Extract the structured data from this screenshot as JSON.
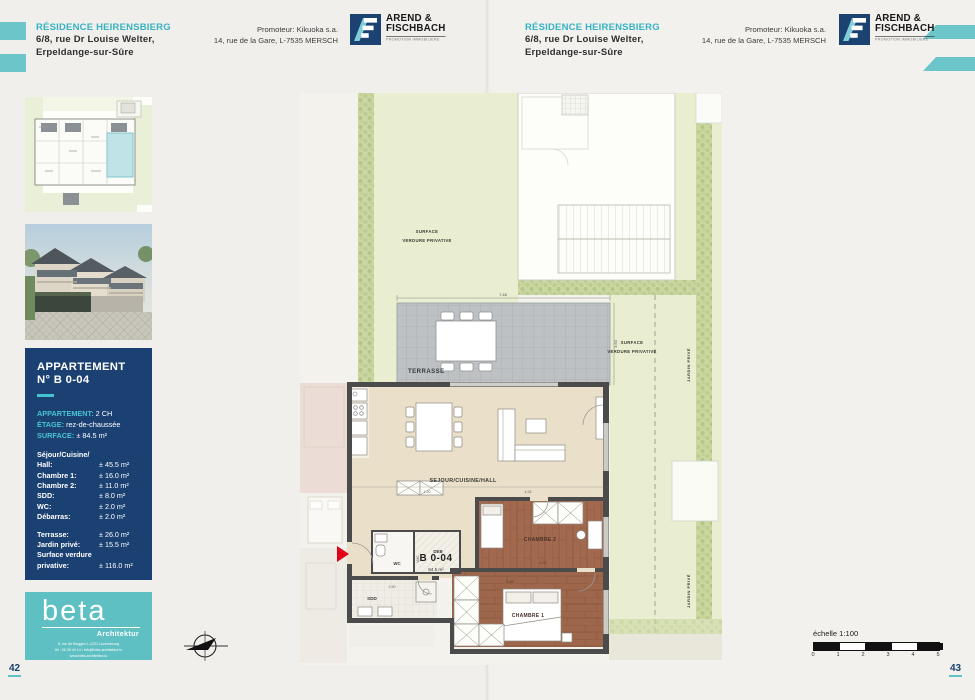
{
  "colors": {
    "accent_teal": "#6cc5c8",
    "title_teal": "#35b2c3",
    "brand_navy": "#1b4173",
    "beta_teal": "#5fc0c3",
    "plan_green": "#e8eecf",
    "wood_brown": "#a2694e",
    "terrace_grey": "#bdc1c3",
    "floor_beige": "#eadfc8",
    "entrance_red": "#e2001a"
  },
  "header": {
    "residence_title": "RÉSIDENCE HEIRENSBIERG",
    "address_line1": "6/8, rue Dr Louise Welter,",
    "address_line2": "Erpeldange-sur-Sûre",
    "promoter_line1": "Promoteur: Kikuoka s.a.",
    "promoter_line2": "14, rue de la Gare, L-7535 MERSCH",
    "logo": {
      "monogram": "AF",
      "name_line1": "AREND &",
      "name_line2": "FISCHBACH",
      "tagline": "PROMOTION IMMOBILIERE"
    }
  },
  "info_box": {
    "title_line1": "APPARTEMENT",
    "title_line2": "N° B 0-04",
    "spec_apartment_label": "APPARTEMENT:",
    "spec_apartment_value": "2 CH",
    "spec_floor_label": "ÉTAGE:",
    "spec_floor_value": "rez-de-chaussée",
    "spec_surface_label": "SURFACE:",
    "spec_surface_value": "± 84.5 m²",
    "rooms": [
      {
        "label": "Séjour/Cuisine/",
        "value": ""
      },
      {
        "label": "Hall:",
        "value": "± 45.5 m²"
      },
      {
        "label": "Chambre 1:",
        "value": "± 16.0 m²"
      },
      {
        "label": "Chambre 2:",
        "value": "± 11.0 m²"
      },
      {
        "label": "SDD:",
        "value": "± 8.0 m²"
      },
      {
        "label": "WC:",
        "value": "± 2.0 m²"
      },
      {
        "label": "Débarras:",
        "value": "± 2.0 m²"
      }
    ],
    "outdoor": [
      {
        "label": "Terrasse:",
        "value": "± 26.0 m²"
      },
      {
        "label": "Jardin privé:",
        "value": "± 15.5 m²"
      },
      {
        "label": "Surface verdure",
        "value": ""
      },
      {
        "label": "privative:",
        "value": "± 116.0 m²"
      }
    ]
  },
  "beta": {
    "name": "beta",
    "subtitle": "Architektur",
    "address_line1": "5, rue de Beggen L-1221 Luxembourg",
    "address_line2": "tél : 26 09 44 14 / info@beta-architektur.lu",
    "address_line3": "www.beta-architektur.lu"
  },
  "plan": {
    "unit_id": "B 0-04",
    "unit_area": "84.5 m²",
    "labels": {
      "surface_line1": "SURFACE",
      "surface_line2": "VERDURE PRIVATIVE",
      "terrasse": "TERRASSE",
      "sejour": "SEJOUR/CUISINE/HALL",
      "wc": "WC",
      "deb": "DEB",
      "vmc": "VMC",
      "sdd": "SDD",
      "chambre1": "CHAMBRE 1",
      "chambre2": "CHAMBRE 2",
      "jardin_prive": "JARDIN PRIVÉ"
    },
    "dims": {
      "terrace_width": "7.48",
      "terrace_depth": "3.50",
      "hall": "1.20",
      "sejour": "4.34",
      "chambre2": "4.32",
      "chambre1": "3.45",
      "sdd": "2.90"
    }
  },
  "scale_bar": {
    "label": "échelle 1:100",
    "ticks": [
      "0",
      "1",
      "2",
      "3",
      "4",
      "5"
    ]
  },
  "pages": {
    "left": "42",
    "right": "43"
  }
}
